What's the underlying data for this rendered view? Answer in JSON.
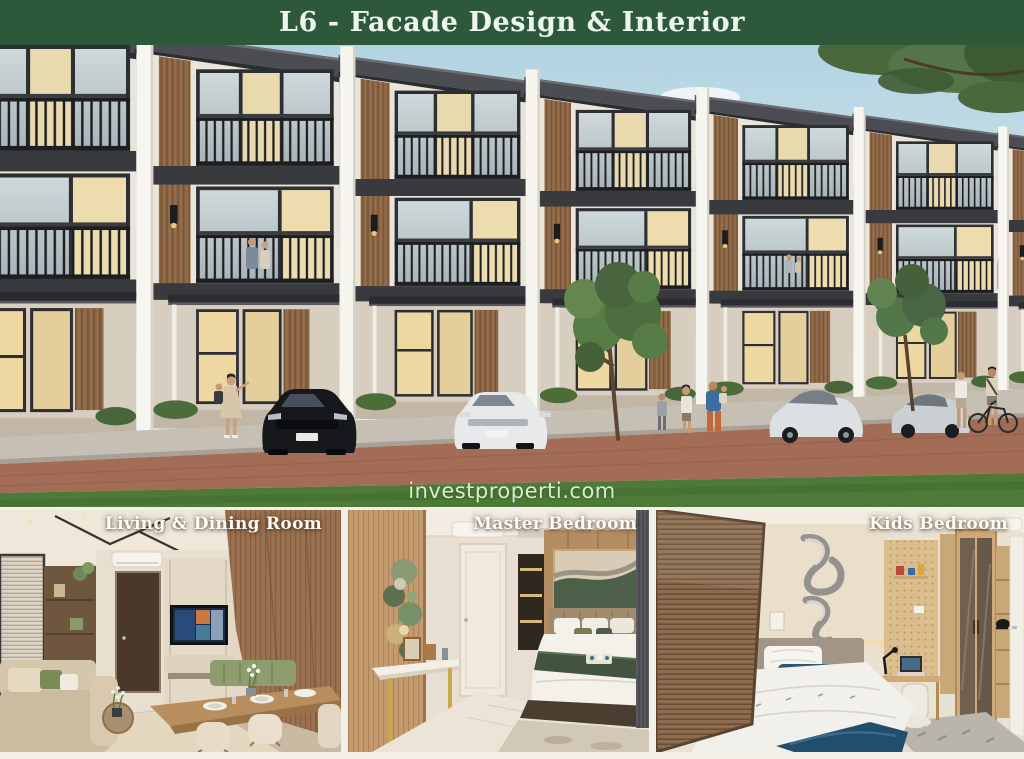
{
  "header": {
    "title": "L6 - Facade Design & Interior"
  },
  "exterior": {
    "watermark": "investproperti.com"
  },
  "interiors": [
    {
      "label": "Living & Dining Room"
    },
    {
      "label": "Master Bedroom"
    },
    {
      "label": "Kids Bedroom"
    }
  ],
  "colors": {
    "header_bg": "#2d5839",
    "header_text": "#edf6ec",
    "watermark_text": "#e2f6dc",
    "divider": "#f2efe8",
    "roof": "#4b4d52",
    "wood_facade": "#8d6746",
    "railing": "#1d1e21",
    "grass": "#4e7a38",
    "road": "#a26c57"
  }
}
